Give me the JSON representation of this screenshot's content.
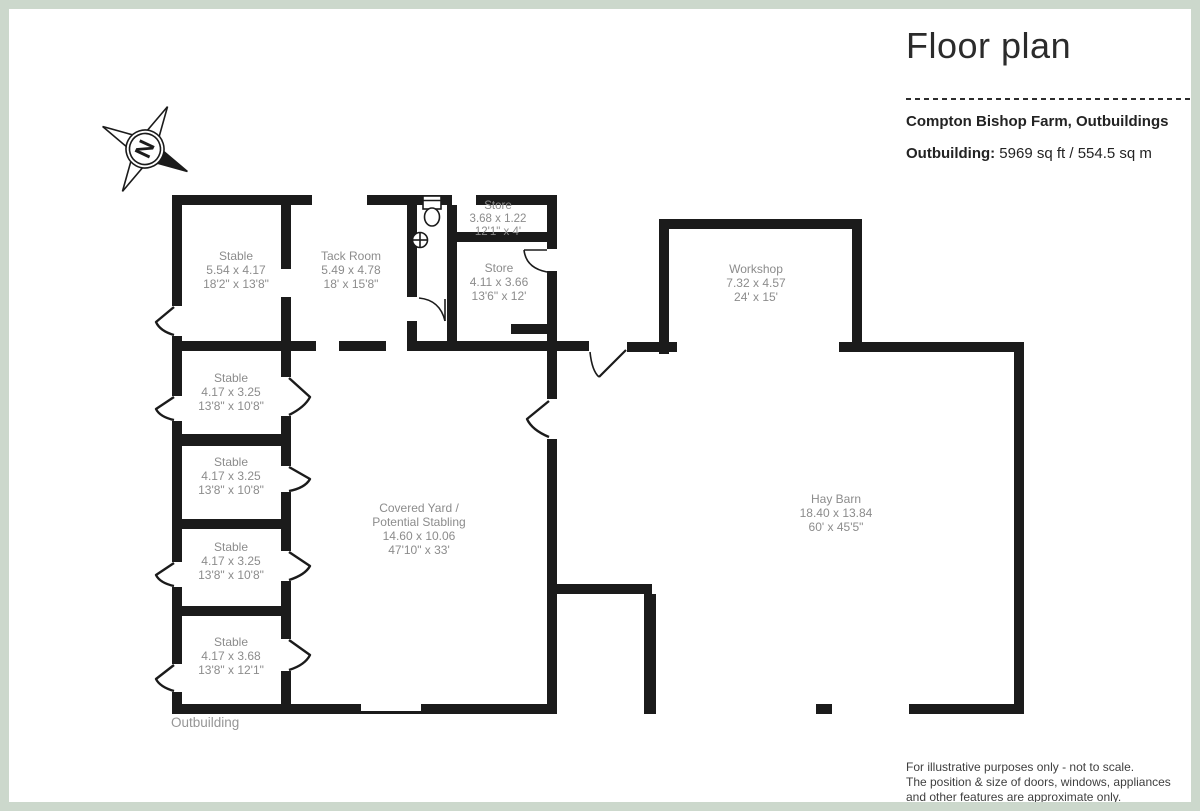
{
  "header": {
    "title": "Floor plan",
    "property": "Compton Bishop Farm, Outbuildings",
    "area_label": "Outbuilding:",
    "area_value": " 5969 sq ft / 554.5 sq m"
  },
  "compass": {
    "north_label": "N"
  },
  "rooms": {
    "stable_large": {
      "name": "Stable",
      "metric": "5.54 x 4.17",
      "imperial": "18'2\" x 13'8\""
    },
    "tack_room": {
      "name": "Tack Room",
      "metric": "5.49 x 4.78",
      "imperial": "18' x 15'8\""
    },
    "store_small": {
      "name": "Store",
      "metric": "3.68 x 1.22",
      "imperial": "12'1\" x 4'"
    },
    "store": {
      "name": "Store",
      "metric": "4.11 x 3.66",
      "imperial": "13'6\" x 12'"
    },
    "workshop": {
      "name": "Workshop",
      "metric": "7.32 x 4.57",
      "imperial": "24' x 15'"
    },
    "covered_yard": {
      "name_line1": "Covered Yard /",
      "name_line2": "Potential Stabling",
      "metric": "14.60 x 10.06",
      "imperial": "47'10\" x 33'"
    },
    "hay_barn": {
      "name": "Hay Barn",
      "metric": "18.40 x 13.84",
      "imperial": "60' x 45'5\""
    },
    "stable_2": {
      "name": "Stable",
      "metric": "4.17 x 3.25",
      "imperial": "13'8\" x 10'8\""
    },
    "stable_3": {
      "name": "Stable",
      "metric": "4.17 x 3.25",
      "imperial": "13'8\" x 10'8\""
    },
    "stable_4": {
      "name": "Stable",
      "metric": "4.17 x 3.25",
      "imperial": "13'8\" x 10'8\""
    },
    "stable_5": {
      "name": "Stable",
      "metric": "4.17 x 3.68",
      "imperial": "13'8\" x 12'1\""
    }
  },
  "labels": {
    "outbuilding": "Outbuilding"
  },
  "disclaimer": {
    "line1": "For illustrative purposes only - not to scale.",
    "line2": "The position & size of doors, windows, appliances",
    "line3": "and other features are approximate only."
  },
  "colors": {
    "wall": "#1b1b1b",
    "border": "#ccd8cc",
    "room_text": "#8c8c8c",
    "heading_text": "#2b2b2b"
  }
}
